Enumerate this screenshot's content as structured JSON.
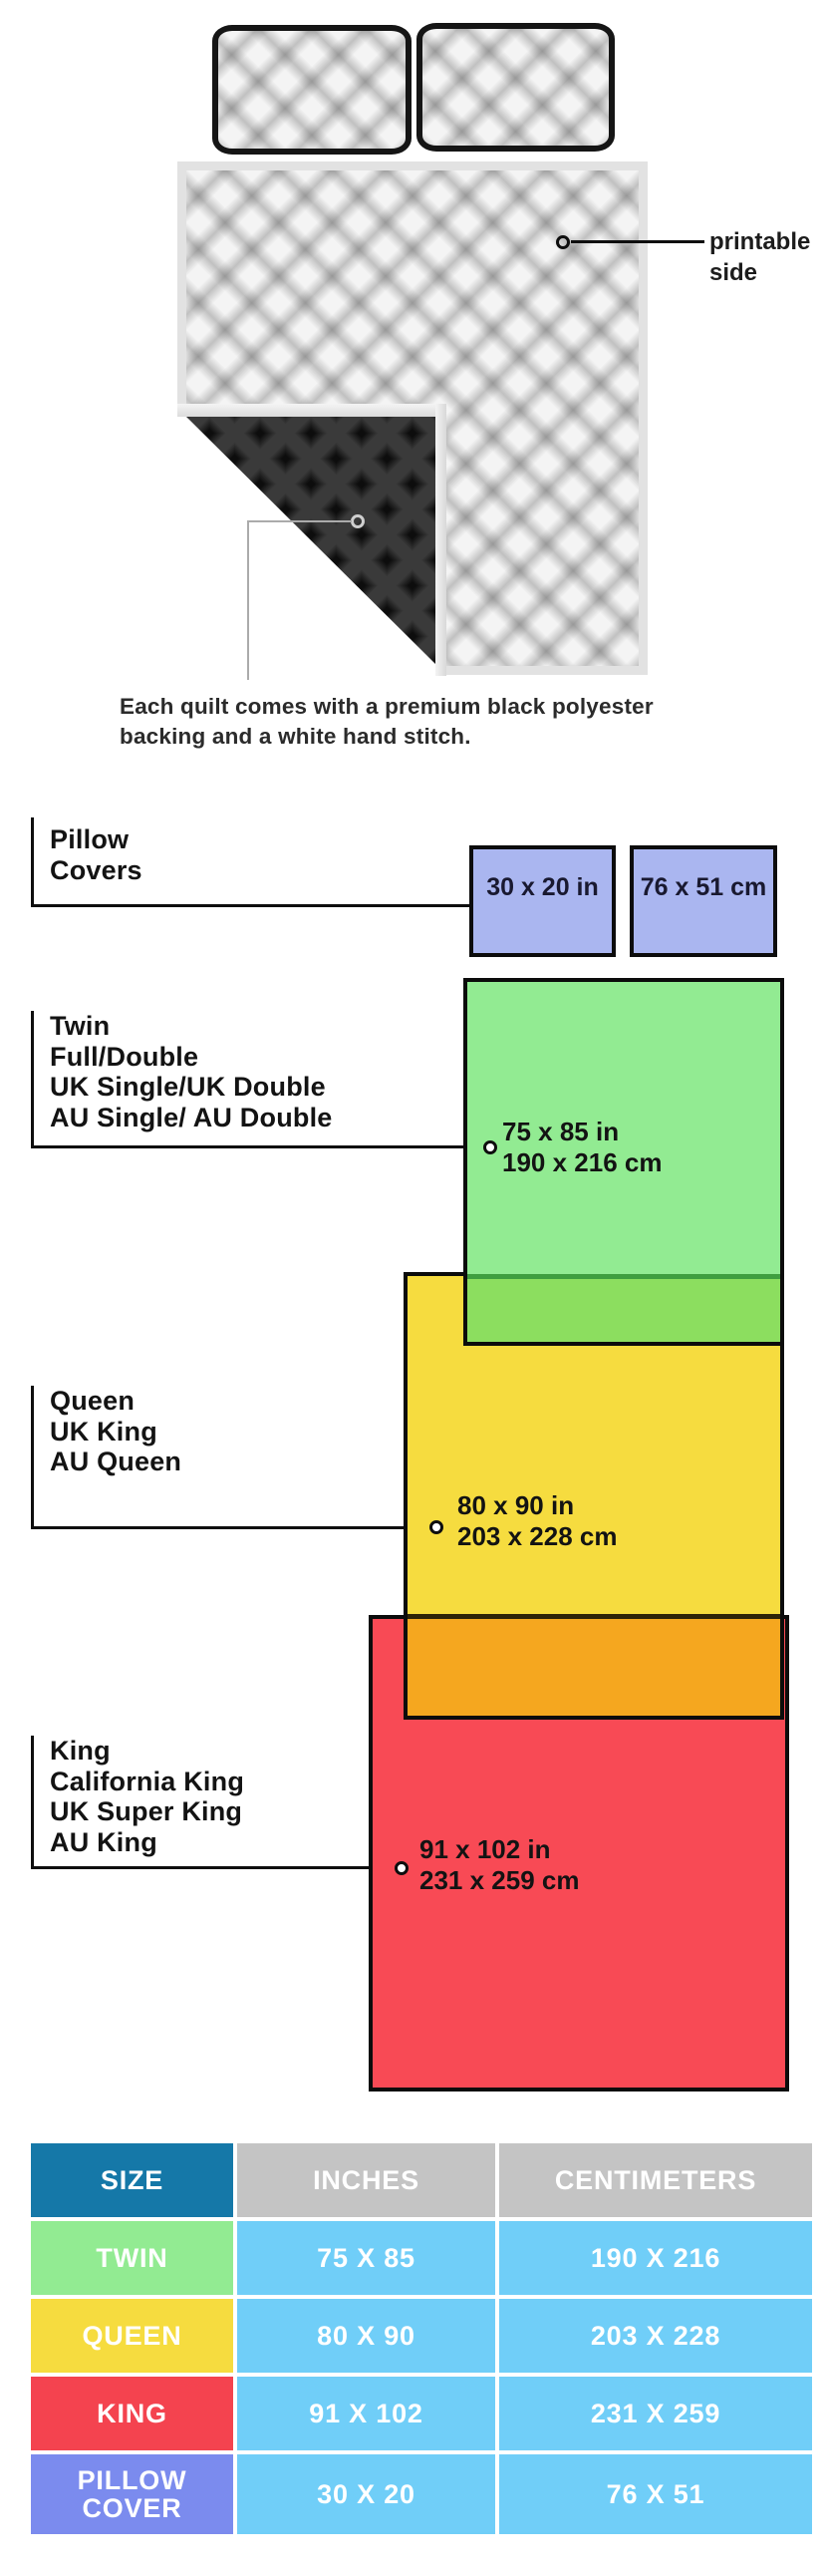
{
  "illustration": {
    "printable_side": {
      "line1": "printable",
      "line2": "side"
    },
    "backing_caption": {
      "line1": "Each quilt comes with a premium black polyester",
      "line2": "backing and a white hand stitch."
    }
  },
  "sizes": {
    "pillow": {
      "labels": {
        "l1": "Pillow",
        "l2": "Covers"
      },
      "dim_in": "30 x 20 in",
      "dim_cm": "76 x 51 cm",
      "fill": "#aab6f0"
    },
    "twin": {
      "labels": {
        "l1": "Twin",
        "l2": "Full/Double",
        "l3": "UK Single/UK Double",
        "l4": "AU Single/ AU Double"
      },
      "dim_in": "75 x 85 in",
      "dim_cm": "190 x 216 cm",
      "fill": "#92eb92",
      "overlap_fill": "#8cde5f"
    },
    "queen": {
      "labels": {
        "l1": "Queen",
        "l2": "UK King",
        "l3": "AU Queen"
      },
      "dim_in": "80 x 90 in",
      "dim_cm": "203 x 228 cm",
      "fill": "#f6dc3f",
      "overlap_fill": "#f5a71f"
    },
    "king": {
      "labels": {
        "l1": "King",
        "l2": "California King",
        "l3": "UK Super King",
        "l4": "AU King"
      },
      "dim_in": "91 x 102 in",
      "dim_cm": "231 x 259 cm",
      "fill": "#f84a55"
    }
  },
  "table": {
    "headers": {
      "size": "SIZE",
      "inches": "INCHES",
      "centimeters": "CENTIMETERS"
    },
    "header_colors": {
      "size": "#1578a8",
      "other": "#c4c4c4"
    },
    "data_cell_color": "#70cef8",
    "rows": {
      "twin": {
        "size": "TWIN",
        "inches": "75 X 85",
        "cm": "190 X 216",
        "color": "#92eb92"
      },
      "queen": {
        "size": "QUEEN",
        "inches": "80 X 90",
        "cm": "203 X 228",
        "color": "#f6dc3f"
      },
      "king": {
        "size": "KING",
        "inches": "91 X 102",
        "cm": "231 X 259",
        "color": "#f4434f"
      },
      "pillow": {
        "size_l1": "PILLOW",
        "size_l2": "COVER",
        "inches": "30 X 20",
        "cm": "76 X 51",
        "color": "#7b8bee"
      }
    }
  }
}
